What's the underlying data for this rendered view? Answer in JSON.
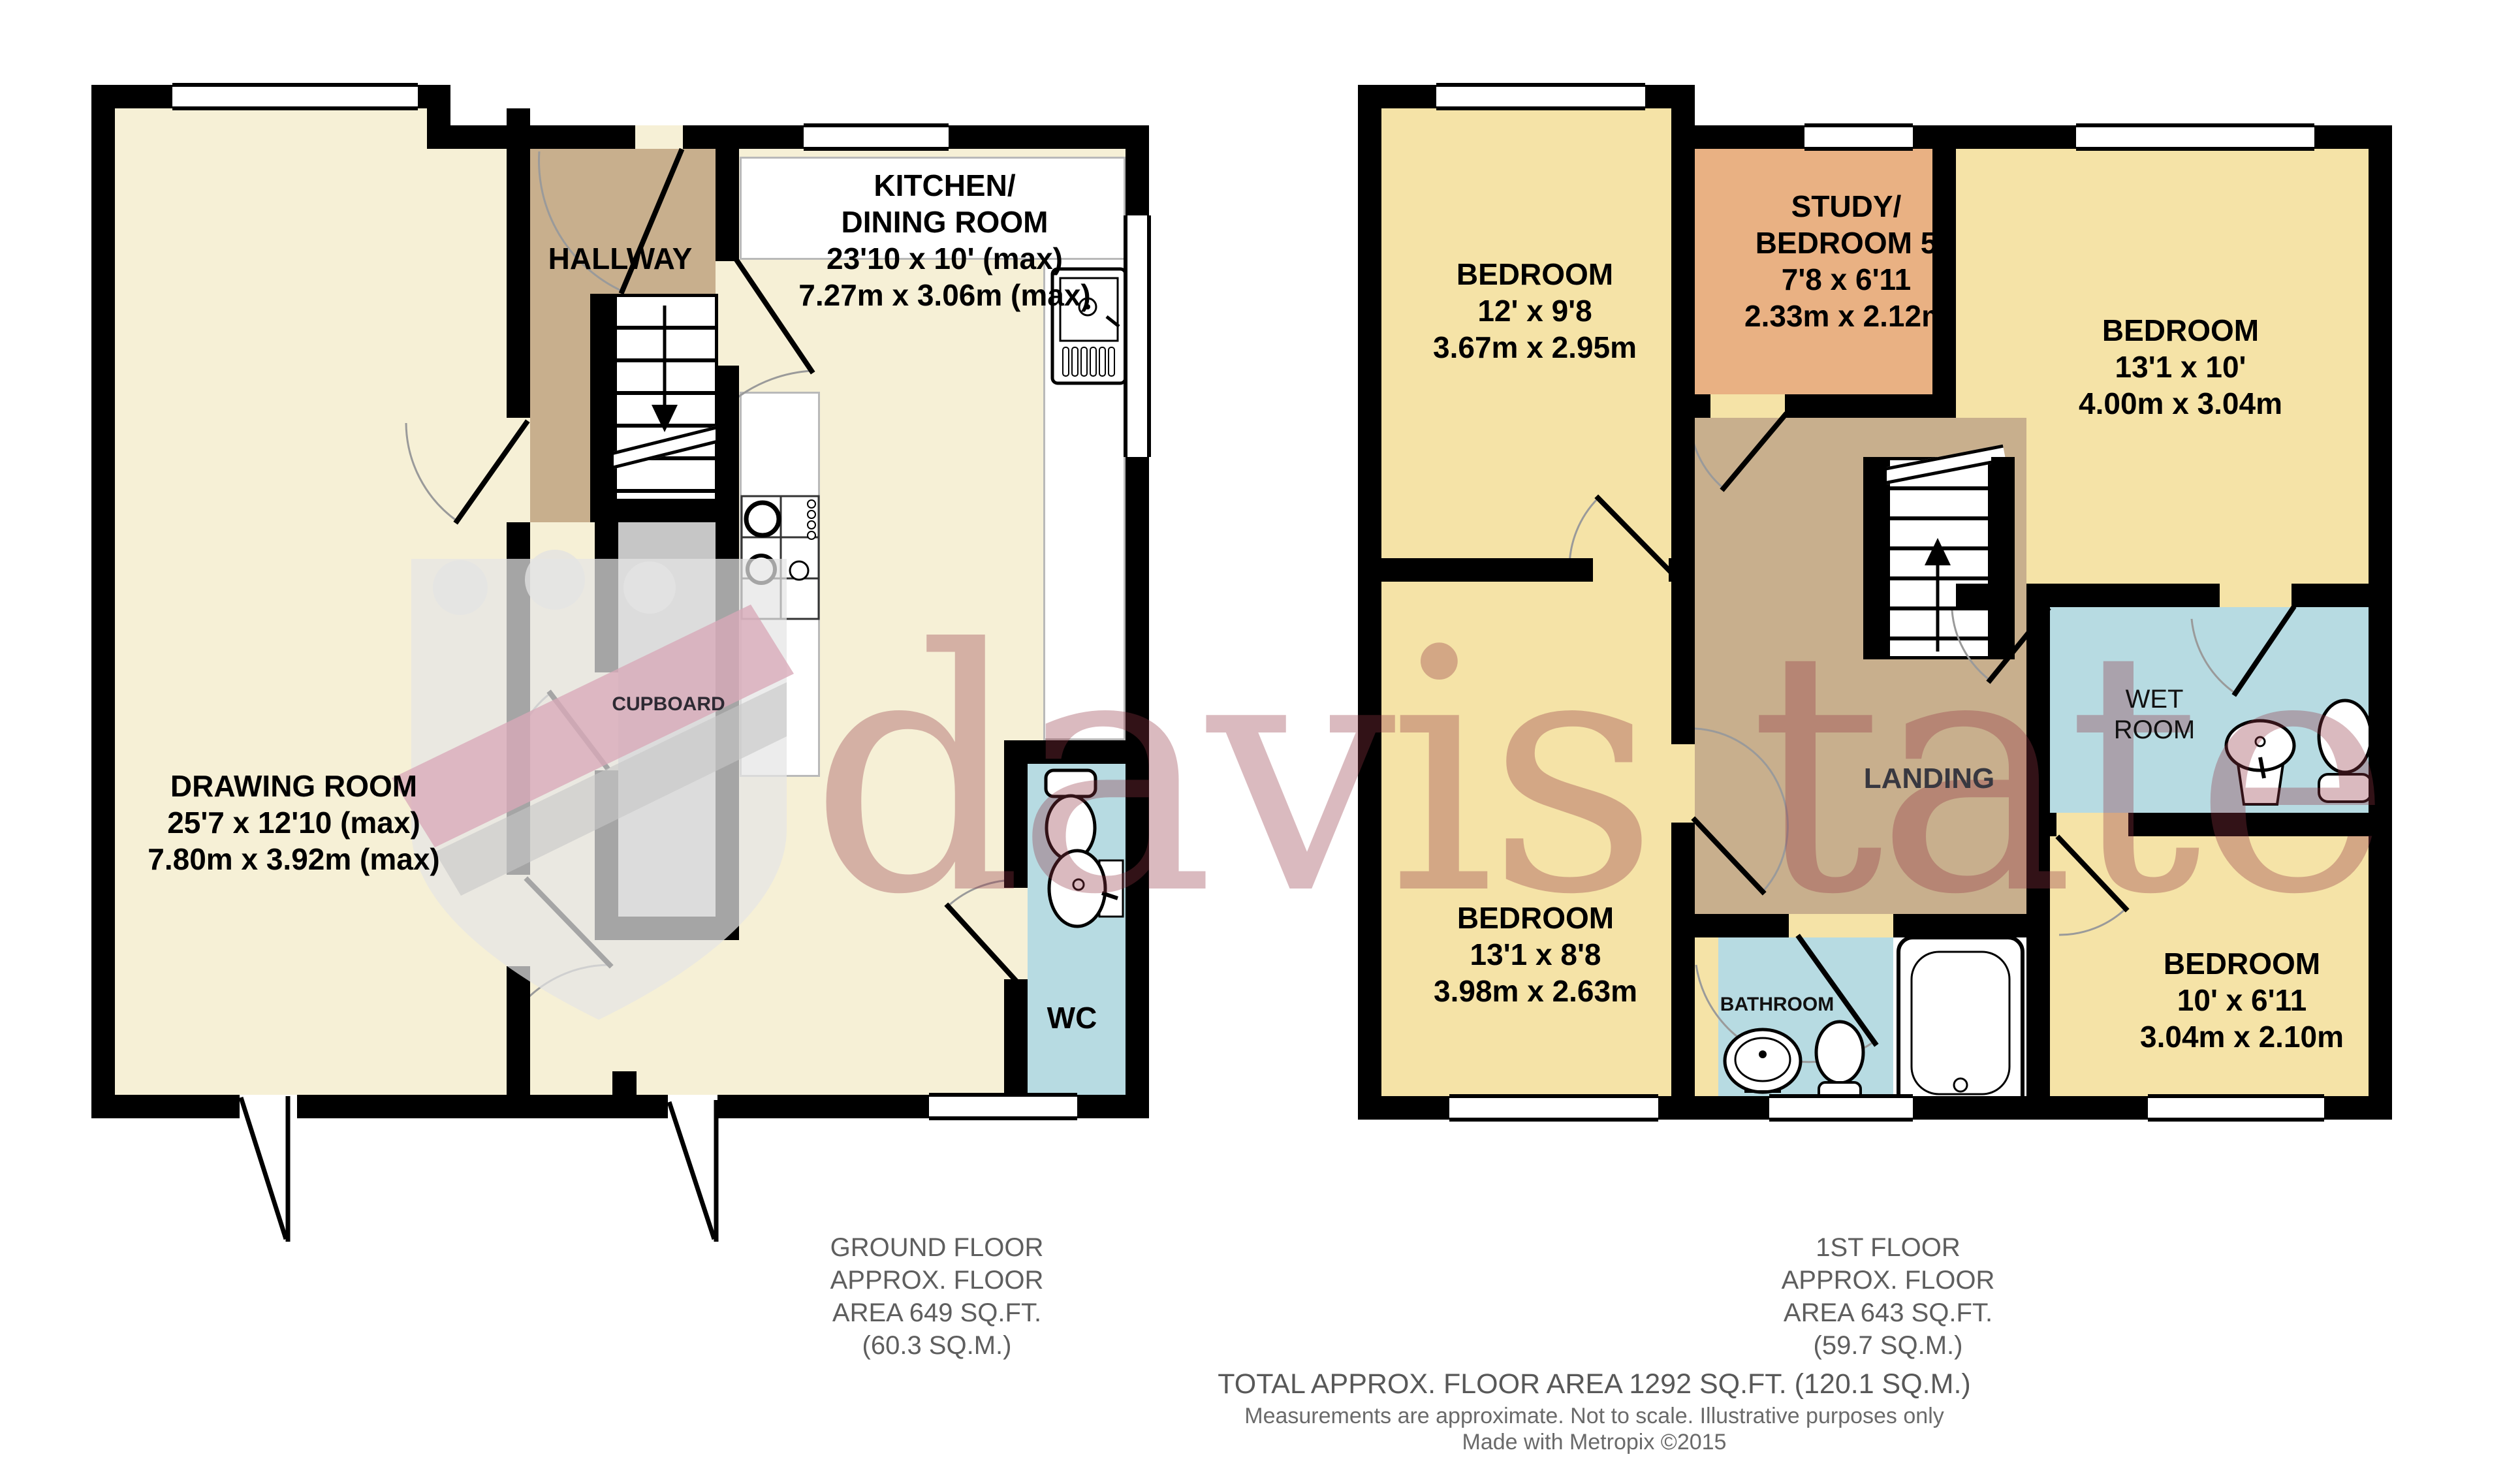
{
  "watermark": {
    "text": "davis tate"
  },
  "colors": {
    "cream": "#F6F0D6",
    "bedroom_yellow": "#F5E3A7",
    "hallway_tan": "#C8AF8D",
    "study_orange": "#E9B183",
    "wet_blue": "#B7DBE2",
    "cupboard_gray": "#C6C6C6",
    "wall_black": "#000000",
    "footer_gray": "#5E5E5E",
    "watermark_pink": "rgba(148,54,66,0.34)"
  },
  "plans": {
    "ground": {
      "rooms": {
        "drawing_room": {
          "name": "DRAWING ROOM",
          "dims": [
            "25'7 x 12'10 (max)",
            "7.80m x 3.92m (max)"
          ]
        },
        "kitchen": {
          "name_lines": [
            "KITCHEN/",
            "DINING ROOM"
          ],
          "dims": [
            "23'10 x 10' (max)",
            "7.27m x 3.06m (max)"
          ]
        },
        "hallway": {
          "name": "HALLWAY"
        },
        "cupboard": {
          "name": "CUPBOARD"
        },
        "wc": {
          "name": "WC"
        }
      },
      "footer": {
        "lines": [
          "GROUND FLOOR",
          "APPROX. FLOOR",
          "AREA 649 SQ.FT.",
          "(60.3 SQ.M.)"
        ]
      }
    },
    "first": {
      "rooms": {
        "bedroom1": {
          "name": "BEDROOM",
          "dims": [
            "12' x 9'8",
            "3.67m x 2.95m"
          ]
        },
        "study": {
          "name_lines": [
            "STUDY/",
            "BEDROOM 5"
          ],
          "dims": [
            "7'8 x 6'11",
            "2.33m x 2.12m"
          ]
        },
        "bedroom2": {
          "name": "BEDROOM",
          "dims": [
            "13'1 x 10'",
            "4.00m x 3.04m"
          ]
        },
        "wet_room": {
          "name_lines": [
            "WET",
            "ROOM"
          ]
        },
        "landing": {
          "name": "LANDING"
        },
        "bedroom3": {
          "name": "BEDROOM",
          "dims": [
            "13'1 x 8'8",
            "3.98m x 2.63m"
          ]
        },
        "bathroom": {
          "name": "BATHROOM"
        },
        "bedroom4": {
          "name": "BEDROOM",
          "dims": [
            "10' x 6'11",
            "3.04m x 2.10m"
          ]
        }
      },
      "footer": {
        "lines": [
          "1ST FLOOR",
          "APPROX. FLOOR",
          "AREA 643 SQ.FT.",
          "(59.7 SQ.M.)"
        ]
      }
    }
  },
  "footer": {
    "total": "TOTAL APPROX. FLOOR AREA 1292 SQ.FT. (120.1 SQ.M.)",
    "disclaimer": "Measurements are approximate.  Not to scale.  Illustrative purposes only",
    "credit": "Made with Metropix ©2015"
  }
}
